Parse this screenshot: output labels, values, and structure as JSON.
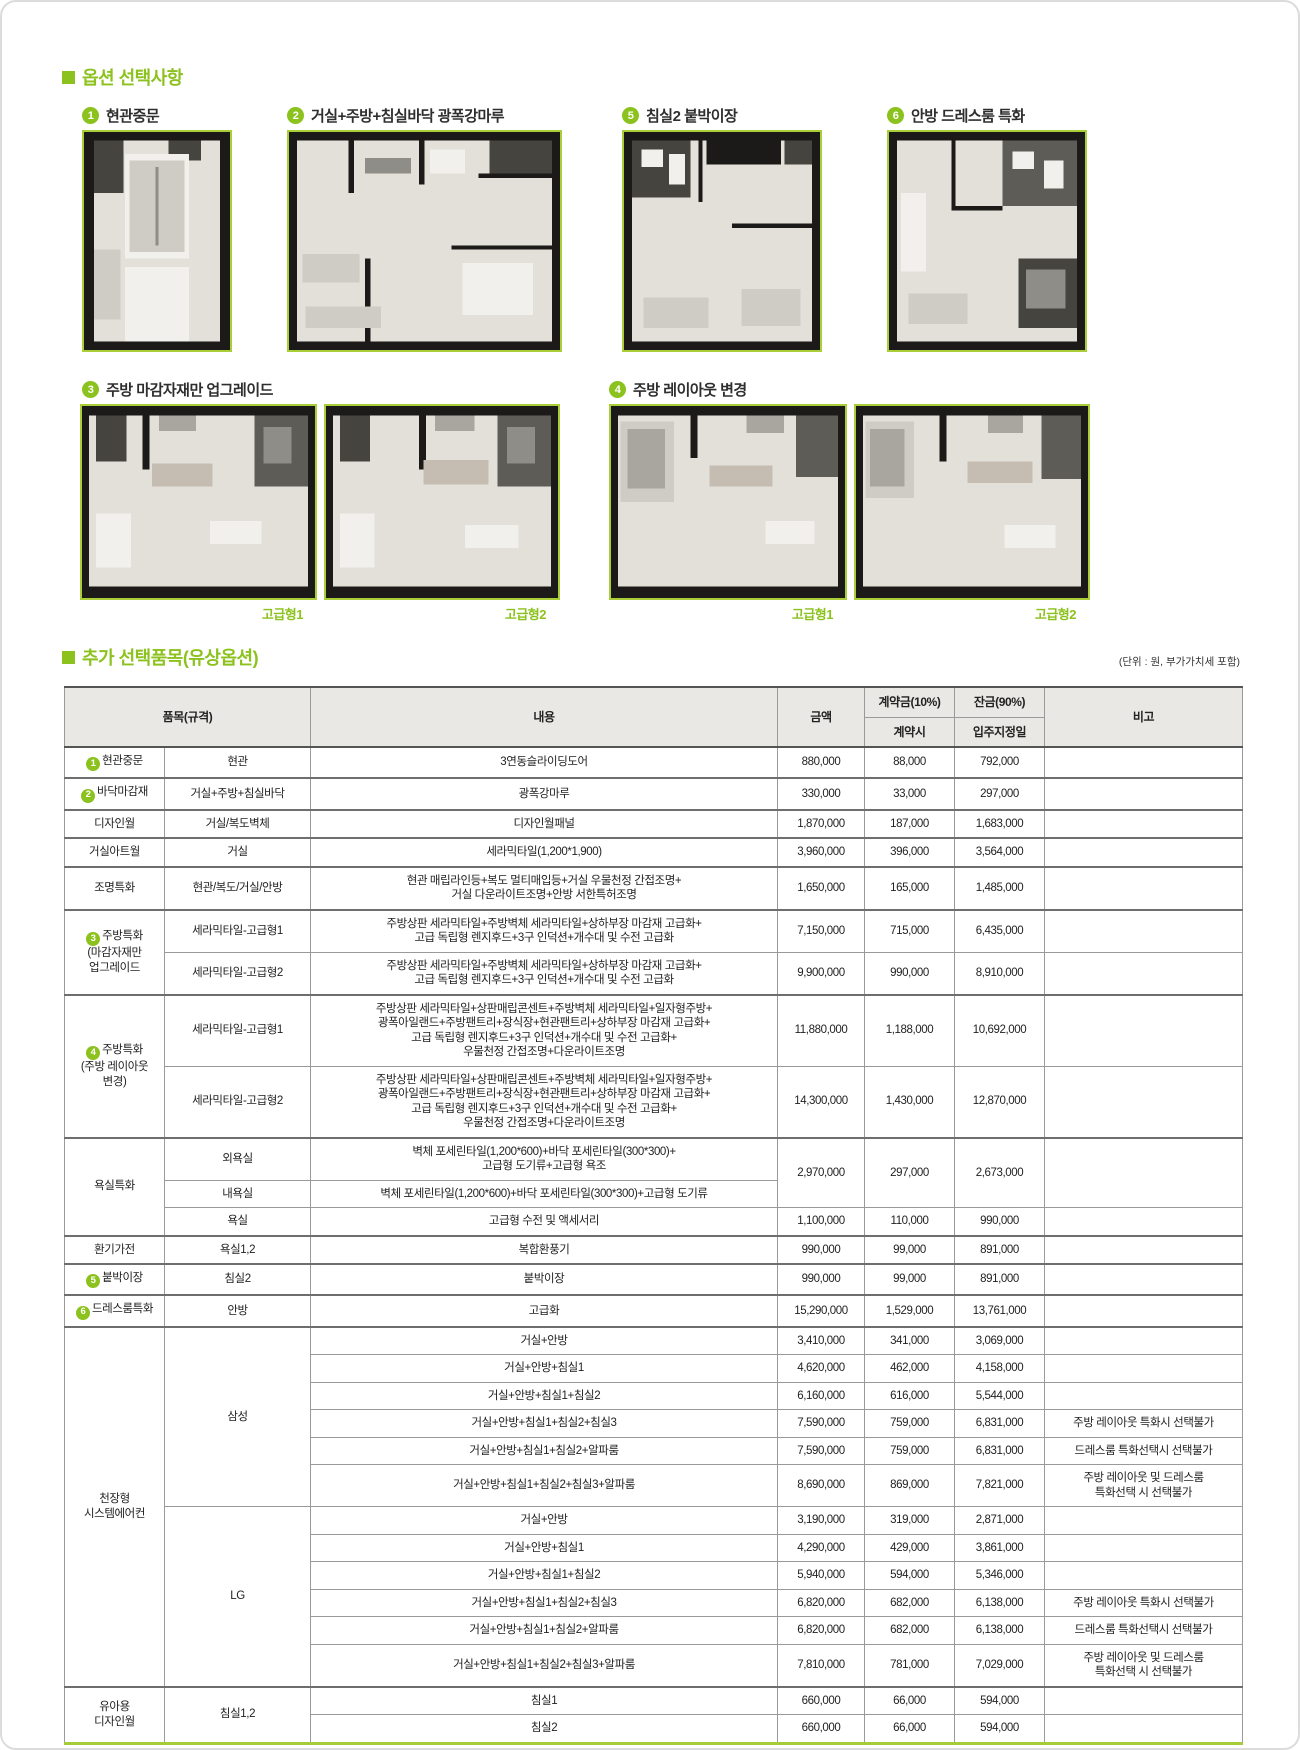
{
  "accent_color": "#8cc21e",
  "image_border_color": "#a9ce38",
  "sections": {
    "options_title": "옵션 선택사항",
    "paid_title": "추가 선택품목(유상옵션)",
    "unit_note": "(단위 : 원, 부가가치세 포함)"
  },
  "options": [
    {
      "num": "1",
      "label": "현관중문"
    },
    {
      "num": "2",
      "label": "거실+주방+침실바닥 광폭강마루"
    },
    {
      "num": "5",
      "label": "침실2 붙박이장"
    },
    {
      "num": "6",
      "label": "안방 드레스룸 특화"
    },
    {
      "num": "3",
      "label": "주방 마감자재만 업그레이드",
      "captions": [
        "고급형1",
        "고급형2"
      ]
    },
    {
      "num": "4",
      "label": "주방 레이아웃 변경",
      "captions": [
        "고급형1",
        "고급형2"
      ]
    }
  ],
  "table": {
    "header": {
      "item": "품목(규격)",
      "content": "내용",
      "amount": "금액",
      "down": "계약금(10%)",
      "down_when": "계약시",
      "balance": "잔금(90%)",
      "balance_when": "입주지정일",
      "note": "비고"
    },
    "rows": [
      {
        "cells": [
          {
            "circle": "1",
            "t": "현관중문"
          },
          {
            "t": "현관"
          },
          {
            "t": "3연동슬라이딩도어"
          },
          {
            "t": "880,000"
          },
          {
            "t": "88,000"
          },
          {
            "t": "792,000"
          },
          {
            "t": ""
          }
        ]
      },
      {
        "g": true,
        "cells": [
          {
            "circle": "2",
            "t": "바닥마감재"
          },
          {
            "t": "거실+주방+침실바닥"
          },
          {
            "t": "광폭강마루"
          },
          {
            "t": "330,000"
          },
          {
            "t": "33,000"
          },
          {
            "t": "297,000"
          },
          {
            "t": ""
          }
        ]
      },
      {
        "g": true,
        "cells": [
          {
            "t": "디자인월"
          },
          {
            "t": "거실/복도벽체"
          },
          {
            "t": "디자인월패널"
          },
          {
            "t": "1,870,000"
          },
          {
            "t": "187,000"
          },
          {
            "t": "1,683,000"
          },
          {
            "t": ""
          }
        ]
      },
      {
        "g": true,
        "cells": [
          {
            "t": "거실아트월"
          },
          {
            "t": "거실"
          },
          {
            "t": "세라믹타일(1,200*1,900)"
          },
          {
            "t": "3,960,000"
          },
          {
            "t": "396,000"
          },
          {
            "t": "3,564,000"
          },
          {
            "t": ""
          }
        ]
      },
      {
        "g": true,
        "cells": [
          {
            "t": "조명특화"
          },
          {
            "t": "현관/복도/거실/안방"
          },
          {
            "lines": [
              "현관 매립라인등+복도 멀티매입등+거실 우물천정 간접조명+",
              "거실 다운라이트조명+안방 서한특허조명"
            ]
          },
          {
            "t": "1,650,000"
          },
          {
            "t": "165,000"
          },
          {
            "t": "1,485,000"
          },
          {
            "t": ""
          }
        ]
      },
      {
        "g": true,
        "cells": [
          {
            "circle": "3",
            "lines": [
              "주방특화",
              "(마감자재만",
              "업그레이드"
            ],
            "rs": 2
          },
          {
            "t": "세라믹타일-고급형1"
          },
          {
            "lines": [
              "주방상판 세라믹타일+주방벽체 세라믹타일+상하부장 마감재 고급화+",
              "고급 독립형 렌지후드+3구 인덕션+개수대 및 수전 고급화"
            ]
          },
          {
            "t": "7,150,000"
          },
          {
            "t": "715,000"
          },
          {
            "t": "6,435,000"
          },
          {
            "t": ""
          }
        ]
      },
      {
        "cells": [
          {
            "t": "세라믹타일-고급형2"
          },
          {
            "lines": [
              "주방상판 세라믹타일+주방벽체 세라믹타일+상하부장 마감재 고급화+",
              "고급 독립형 렌지후드+3구 인덕션+개수대 및 수전 고급화"
            ]
          },
          {
            "t": "9,900,000"
          },
          {
            "t": "990,000"
          },
          {
            "t": "8,910,000"
          },
          {
            "t": ""
          }
        ]
      },
      {
        "g": true,
        "cells": [
          {
            "circle": "4",
            "lines": [
              "주방특화",
              "(주방 레이아웃",
              "변경)"
            ],
            "rs": 2
          },
          {
            "t": "세라믹타일-고급형1"
          },
          {
            "lines": [
              "주방상판 세라믹타일+상판매립콘센트+주방벽체 세라믹타일+일자형주방+",
              "광폭아일랜드+주방팬트리+장식장+현관팬트리+상하부장 마감재 고급화+",
              "고급 독립형 렌지후드+3구 인덕션+개수대 및 수전 고급화+",
              "우물천정 간접조명+다운라이트조명"
            ]
          },
          {
            "t": "11,880,000"
          },
          {
            "t": "1,188,000"
          },
          {
            "t": "10,692,000"
          },
          {
            "t": ""
          }
        ]
      },
      {
        "cells": [
          {
            "t": "세라믹타일-고급형2"
          },
          {
            "lines": [
              "주방상판 세라믹타일+상판매립콘센트+주방벽체 세라믹타일+일자형주방+",
              "광폭아일랜드+주방팬트리+장식장+현관팬트리+상하부장 마감재 고급화+",
              "고급 독립형 렌지후드+3구 인덕션+개수대 및 수전 고급화+",
              "우물천정 간접조명+다운라이트조명"
            ]
          },
          {
            "t": "14,300,000"
          },
          {
            "t": "1,430,000"
          },
          {
            "t": "12,870,000"
          },
          {
            "t": ""
          }
        ]
      },
      {
        "g": true,
        "cells": [
          {
            "t": "욕실특화",
            "rs": 3
          },
          {
            "t": "외욕실"
          },
          {
            "lines": [
              "벽체 포세린타일(1,200*600)+바닥 포세린타일(300*300)+",
              "고급형 도기류+고급형 욕조"
            ]
          },
          {
            "t": "2,970,000",
            "rs": 2
          },
          {
            "t": "297,000",
            "rs": 2
          },
          {
            "t": "2,673,000",
            "rs": 2
          },
          {
            "t": "",
            "rs": 2
          }
        ]
      },
      {
        "cells": [
          {
            "t": "내욕실"
          },
          {
            "t": "벽체 포세린타일(1,200*600)+바닥 포세린타일(300*300)+고급형 도기류"
          }
        ]
      },
      {
        "cells": [
          {
            "t": "욕실"
          },
          {
            "t": "고급형 수전 및 액세서리"
          },
          {
            "t": "1,100,000"
          },
          {
            "t": "110,000"
          },
          {
            "t": "990,000"
          },
          {
            "t": ""
          }
        ]
      },
      {
        "g": true,
        "cells": [
          {
            "t": "환기가전"
          },
          {
            "t": "욕실1,2"
          },
          {
            "t": "복합환풍기"
          },
          {
            "t": "990,000"
          },
          {
            "t": "99,000"
          },
          {
            "t": "891,000"
          },
          {
            "t": ""
          }
        ]
      },
      {
        "g": true,
        "cells": [
          {
            "circle": "5",
            "t": "붙박이장"
          },
          {
            "t": "침실2"
          },
          {
            "t": "붙박이장"
          },
          {
            "t": "990,000"
          },
          {
            "t": "99,000"
          },
          {
            "t": "891,000"
          },
          {
            "t": ""
          }
        ]
      },
      {
        "g": true,
        "cells": [
          {
            "circle": "6",
            "t": "드레스룸특화"
          },
          {
            "t": "안방"
          },
          {
            "t": "고급화"
          },
          {
            "t": "15,290,000"
          },
          {
            "t": "1,529,000"
          },
          {
            "t": "13,761,000"
          },
          {
            "t": ""
          }
        ]
      },
      {
        "g": true,
        "cells": [
          {
            "lines": [
              "천장형",
              "시스템에어컨"
            ],
            "rs": 12
          },
          {
            "t": "삼성",
            "rs": 6
          },
          {
            "t": "거실+안방"
          },
          {
            "t": "3,410,000"
          },
          {
            "t": "341,000"
          },
          {
            "t": "3,069,000"
          },
          {
            "t": ""
          }
        ]
      },
      {
        "cells": [
          {
            "t": "거실+안방+침실1"
          },
          {
            "t": "4,620,000"
          },
          {
            "t": "462,000"
          },
          {
            "t": "4,158,000"
          },
          {
            "t": ""
          }
        ]
      },
      {
        "cells": [
          {
            "t": "거실+안방+침실1+침실2"
          },
          {
            "t": "6,160,000"
          },
          {
            "t": "616,000"
          },
          {
            "t": "5,544,000"
          },
          {
            "t": ""
          }
        ]
      },
      {
        "cells": [
          {
            "t": "거실+안방+침실1+침실2+침실3"
          },
          {
            "t": "7,590,000"
          },
          {
            "t": "759,000"
          },
          {
            "t": "6,831,000"
          },
          {
            "t": "주방 레이아웃 특화시 선택불가"
          }
        ]
      },
      {
        "cells": [
          {
            "t": "거실+안방+침실1+침실2+알파룸"
          },
          {
            "t": "7,590,000"
          },
          {
            "t": "759,000"
          },
          {
            "t": "6,831,000"
          },
          {
            "t": "드레스룸 특화선택시 선택불가"
          }
        ]
      },
      {
        "cells": [
          {
            "t": "거실+안방+침실1+침실2+침실3+알파룸"
          },
          {
            "t": "8,690,000"
          },
          {
            "t": "869,000"
          },
          {
            "t": "7,821,000"
          },
          {
            "lines": [
              "주방 레이아웃 및 드레스룸",
              "특화선택 시 선택불가"
            ]
          }
        ]
      },
      {
        "cells": [
          {
            "t": "LG",
            "rs": 6
          },
          {
            "t": "거실+안방"
          },
          {
            "t": "3,190,000"
          },
          {
            "t": "319,000"
          },
          {
            "t": "2,871,000"
          },
          {
            "t": ""
          }
        ]
      },
      {
        "cells": [
          {
            "t": "거실+안방+침실1"
          },
          {
            "t": "4,290,000"
          },
          {
            "t": "429,000"
          },
          {
            "t": "3,861,000"
          },
          {
            "t": ""
          }
        ]
      },
      {
        "cells": [
          {
            "t": "거실+안방+침실1+침실2"
          },
          {
            "t": "5,940,000"
          },
          {
            "t": "594,000"
          },
          {
            "t": "5,346,000"
          },
          {
            "t": ""
          }
        ]
      },
      {
        "cells": [
          {
            "t": "거실+안방+침실1+침실2+침실3"
          },
          {
            "t": "6,820,000"
          },
          {
            "t": "682,000"
          },
          {
            "t": "6,138,000"
          },
          {
            "t": "주방 레이아웃 특화시 선택불가"
          }
        ]
      },
      {
        "cells": [
          {
            "t": "거실+안방+침실1+침실2+알파룸"
          },
          {
            "t": "6,820,000"
          },
          {
            "t": "682,000"
          },
          {
            "t": "6,138,000"
          },
          {
            "t": "드레스룸 특화선택시 선택불가"
          }
        ]
      },
      {
        "cells": [
          {
            "t": "거실+안방+침실1+침실2+침실3+알파룸"
          },
          {
            "t": "7,810,000"
          },
          {
            "t": "781,000"
          },
          {
            "t": "7,029,000"
          },
          {
            "lines": [
              "주방 레이아웃 및 드레스룸",
              "특화선택 시 선택불가"
            ]
          }
        ]
      },
      {
        "g": true,
        "cells": [
          {
            "lines": [
              "유아용",
              "디자인월"
            ],
            "rs": 2
          },
          {
            "t": "침실1,2",
            "rs": 2
          },
          {
            "t": "침실1"
          },
          {
            "t": "660,000"
          },
          {
            "t": "66,000"
          },
          {
            "t": "594,000"
          },
          {
            "t": ""
          }
        ]
      },
      {
        "cells": [
          {
            "t": "침실2"
          },
          {
            "t": "660,000"
          },
          {
            "t": "66,000"
          },
          {
            "t": "594,000"
          },
          {
            "t": ""
          }
        ]
      }
    ]
  }
}
